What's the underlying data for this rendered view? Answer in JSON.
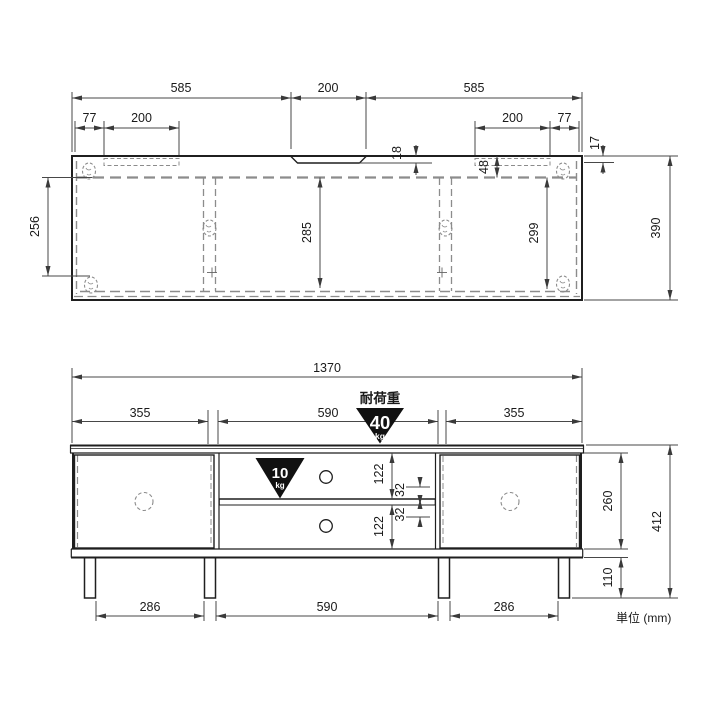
{
  "unit_note": "単位 (mm)",
  "load": {
    "title": "耐荷重",
    "top_capacity": "40",
    "top_unit": "kg",
    "shelf_capacity": "10",
    "shelf_unit": "kg"
  },
  "top_view": {
    "span_left": "585",
    "span_center": "200",
    "span_right": "585",
    "offset_left": "77",
    "inset_left": "200",
    "inset_right": "200",
    "offset_right": "77",
    "notch_depth": "18",
    "edge_lip": "17",
    "back_inset": "48",
    "depth_left": "256",
    "depth_center": "285",
    "depth_right": "299",
    "depth_total": "390"
  },
  "front_view": {
    "width_total": "1370",
    "door_left": "355",
    "opening_width": "590",
    "door_right": "355",
    "opening_upper": "122",
    "opening_lower": "122",
    "pitch_upper": "32",
    "pitch_lower": "32",
    "inner_height": "260",
    "total_height": "412",
    "leg_height": "110",
    "leg_span_left": "286",
    "leg_span_center": "590",
    "leg_span_right": "286"
  }
}
